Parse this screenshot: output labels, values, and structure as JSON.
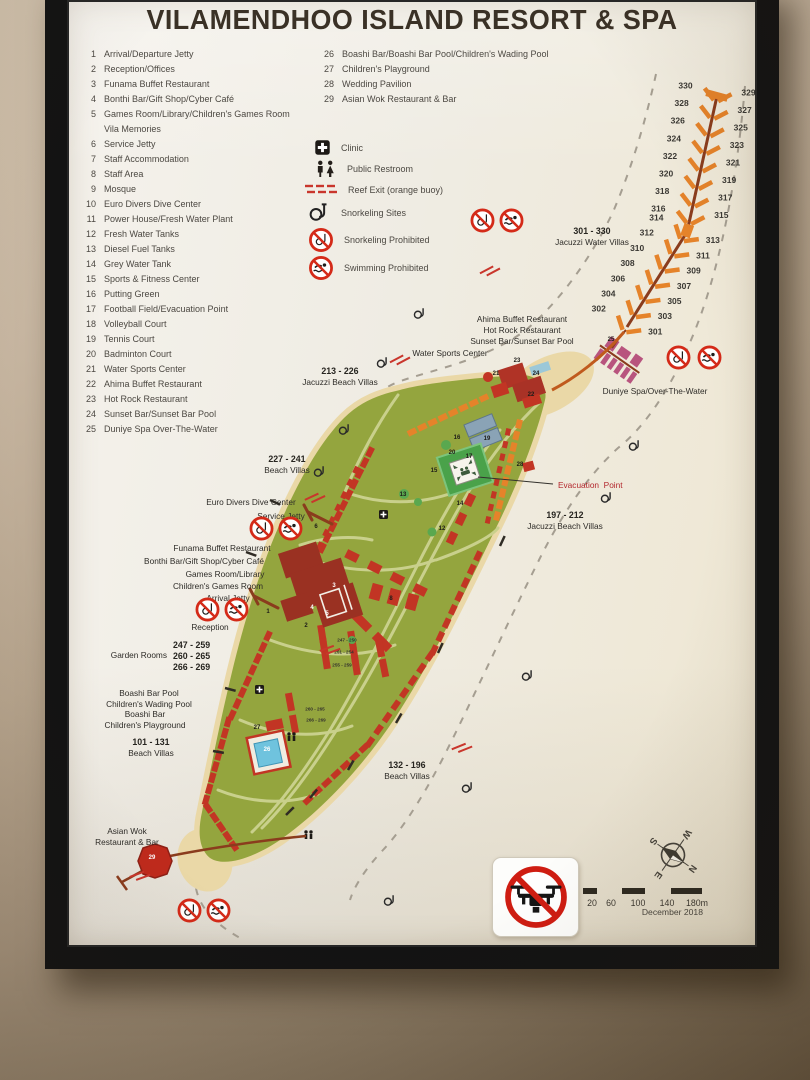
{
  "poster": {
    "title": "VILAMENDHOO ISLAND RESORT & SPA"
  },
  "colors": {
    "island_green": "#94a53e",
    "path_green": "#c9d08c",
    "sand": "#ead8a7",
    "villa_red": "#c23524",
    "villa_orange": "#e5832a",
    "complex_red": "#9a3122",
    "spa_pink": "#b8547e",
    "prohibition_red": "#d42a18",
    "reef_gray": "#a59e91",
    "reef_exit_red": "#c9362c",
    "jetty_brown": "#8a3c1d",
    "evacuation_red": "#b3272d",
    "tennis_blue": "#8aa3b6",
    "pool_blue": "#6fc3de",
    "field_green": "#4aa24a"
  },
  "legend": {
    "items_left": [
      {
        "num": "1",
        "label": "Arrival/Departure Jetty"
      },
      {
        "num": "2",
        "label": "Reception/Offices"
      },
      {
        "num": "3",
        "label": "Funama Buffet Restaurant"
      },
      {
        "num": "4",
        "label": "Bonthi Bar/Gift Shop/Cyber Café"
      },
      {
        "num": "5",
        "label": "Games Room/Library/Children's Games Room"
      },
      {
        "num": "",
        "label": "Vila Memories"
      },
      {
        "num": "6",
        "label": "Service Jetty"
      },
      {
        "num": "7",
        "label": "Staff Accommodation"
      },
      {
        "num": "8",
        "label": "Staff Area"
      },
      {
        "num": "9",
        "label": "Mosque"
      },
      {
        "num": "10",
        "label": "Euro Divers Dive Center"
      },
      {
        "num": "11",
        "label": "Power House/Fresh Water Plant"
      },
      {
        "num": "12",
        "label": "Fresh Water Tanks"
      },
      {
        "num": "13",
        "label": "Diesel Fuel Tanks"
      },
      {
        "num": "14",
        "label": "Grey Water Tank"
      },
      {
        "num": "15",
        "label": "Sports & Fitness Center"
      },
      {
        "num": "16",
        "label": "Putting Green"
      },
      {
        "num": "17",
        "label": "Football Field/Evacuation Point"
      },
      {
        "num": "18",
        "label": "Volleyball Court"
      },
      {
        "num": "19",
        "label": "Tennis Court"
      },
      {
        "num": "20",
        "label": "Badminton Court"
      },
      {
        "num": "21",
        "label": "Water Sports Center"
      },
      {
        "num": "22",
        "label": "Ahima Buffet Restaurant"
      },
      {
        "num": "23",
        "label": "Hot Rock Restaurant"
      },
      {
        "num": "24",
        "label": "Sunset Bar/Sunset Bar Pool"
      },
      {
        "num": "25",
        "label": "Duniye Spa Over-The-Water"
      }
    ],
    "items_right": [
      {
        "num": "26",
        "label": "Boashi Bar/Boashi Bar Pool/Children's Wading Pool"
      },
      {
        "num": "27",
        "label": "Children's Playground"
      },
      {
        "num": "28",
        "label": "Wedding Pavilion"
      },
      {
        "num": "29",
        "label": "Asian Wok Restaurant & Bar"
      }
    ],
    "symbols": [
      {
        "icon": "clinic-icon",
        "label": "Clinic"
      },
      {
        "icon": "restroom-icon",
        "label": "Public Restroom"
      },
      {
        "icon": "reef-exit-icon",
        "label": "Reef Exit (orange buoy)"
      },
      {
        "icon": "snorkel-icon",
        "label": "Snorkeling Sites"
      },
      {
        "icon": "no-snorkel-icon",
        "label": "Snorkeling Prohibited"
      },
      {
        "icon": "no-swim-icon",
        "label": "Swimming Prohibited"
      }
    ]
  },
  "map": {
    "labels": [
      {
        "x": 340,
        "y": 366,
        "align": "center",
        "lines": [
          {
            "t": "213 - 226",
            "b": 1
          },
          {
            "t": "Jacuzzi Beach Villas",
            "b": 0
          }
        ]
      },
      {
        "x": 287,
        "y": 454,
        "align": "center",
        "lines": [
          {
            "t": "227 - 241",
            "b": 1
          },
          {
            "t": "Beach Villas",
            "b": 0
          }
        ]
      },
      {
        "x": 251,
        "y": 497,
        "align": "center",
        "lines": [
          {
            "t": "Euro Divers Dive Center",
            "b": 0
          }
        ]
      },
      {
        "x": 281,
        "y": 511,
        "align": "center",
        "lines": [
          {
            "t": "Service Jetty",
            "b": 0
          }
        ]
      },
      {
        "x": 222,
        "y": 543,
        "align": "center",
        "lines": [
          {
            "t": "Funama Buffet Restaurant",
            "b": 0
          }
        ]
      },
      {
        "x": 204,
        "y": 556,
        "align": "center",
        "lines": [
          {
            "t": "Bonthi Bar/Gift Shop/Cyber Café",
            "b": 0
          }
        ]
      },
      {
        "x": 225,
        "y": 569,
        "align": "center",
        "lines": [
          {
            "t": "Games Room/Library",
            "b": 0
          }
        ]
      },
      {
        "x": 218,
        "y": 581,
        "align": "center",
        "lines": [
          {
            "t": "Children's Games Room",
            "b": 0
          }
        ]
      },
      {
        "x": 228,
        "y": 593,
        "align": "center",
        "lines": [
          {
            "t": "Arrival Jetty",
            "b": 0
          }
        ]
      },
      {
        "x": 210,
        "y": 622,
        "align": "center",
        "lines": [
          {
            "t": "Reception",
            "b": 0
          }
        ]
      },
      {
        "x": 167,
        "y": 650,
        "align": "right",
        "lines": [
          {
            "t": "Garden Rooms",
            "b": 0
          }
        ]
      },
      {
        "x": 173,
        "y": 640,
        "align": "left",
        "lines": [
          {
            "t": "247 - 259",
            "b": 1
          },
          {
            "t": "260 - 265",
            "b": 1
          },
          {
            "t": "266 - 269",
            "b": 1
          }
        ]
      },
      {
        "x": 149,
        "y": 688,
        "align": "center",
        "lines": [
          {
            "t": "Boashi Bar Pool",
            "b": 0
          },
          {
            "t": "Children's Wading Pool",
            "b": 0
          }
        ]
      },
      {
        "x": 145,
        "y": 709,
        "align": "center",
        "lines": [
          {
            "t": "Boashi Bar",
            "b": 0
          },
          {
            "t": "Children's Playground",
            "b": 0
          }
        ]
      },
      {
        "x": 151,
        "y": 737,
        "align": "center",
        "lines": [
          {
            "t": "101 - 131",
            "b": 1
          },
          {
            "t": "Beach Villas",
            "b": 0
          }
        ]
      },
      {
        "x": 127,
        "y": 826,
        "align": "center",
        "lines": [
          {
            "t": "Asian Wok",
            "b": 0
          },
          {
            "t": "Restaurant & Bar",
            "b": 0
          }
        ]
      },
      {
        "x": 522,
        "y": 314,
        "align": "center",
        "lines": [
          {
            "t": "Ahima Buffet Restaurant",
            "b": 0
          },
          {
            "t": "Hot Rock Restaurant",
            "b": 0
          },
          {
            "t": "Sunset Bar/Sunset Bar Pool",
            "b": 0
          }
        ]
      },
      {
        "x": 450,
        "y": 348,
        "align": "center",
        "lines": [
          {
            "t": "Water Sports Center",
            "b": 0
          }
        ]
      },
      {
        "x": 592,
        "y": 226,
        "align": "center",
        "lines": [
          {
            "t": "301 - 330",
            "b": 1
          },
          {
            "t": "Jacuzzi Water Villas",
            "b": 0
          }
        ]
      },
      {
        "x": 655,
        "y": 386,
        "align": "center",
        "lines": [
          {
            "t": "Duniye Spa/Over-The-Water",
            "b": 0
          }
        ]
      },
      {
        "x": 558,
        "y": 480,
        "align": "left",
        "color": "#b3272d",
        "lines": [
          {
            "t": "Evacuation  Point",
            "b": 0
          }
        ]
      },
      {
        "x": 565,
        "y": 510,
        "align": "center",
        "lines": [
          {
            "t": "197 - 212",
            "b": 1
          },
          {
            "t": "Jacuzzi Beach Villas",
            "b": 0
          }
        ]
      },
      {
        "x": 407,
        "y": 760,
        "align": "center",
        "lines": [
          {
            "t": "132 - 196",
            "b": 1
          },
          {
            "t": "Beach Villas",
            "b": 0
          }
        ]
      }
    ],
    "markers_dark": [
      {
        "n": "1",
        "x": 268,
        "y": 612
      },
      {
        "n": "2",
        "x": 306,
        "y": 626
      },
      {
        "n": "6",
        "x": 316,
        "y": 527
      },
      {
        "n": "8",
        "x": 391,
        "y": 599
      },
      {
        "n": "12",
        "x": 442,
        "y": 529
      },
      {
        "n": "13",
        "x": 403,
        "y": 495
      },
      {
        "n": "14",
        "x": 460,
        "y": 504
      },
      {
        "n": "15",
        "x": 434,
        "y": 471
      },
      {
        "n": "16",
        "x": 457,
        "y": 438
      },
      {
        "n": "17",
        "x": 469,
        "y": 457
      },
      {
        "n": "19",
        "x": 487,
        "y": 439
      },
      {
        "n": "20",
        "x": 452,
        "y": 453
      },
      {
        "n": "21",
        "x": 496,
        "y": 374
      },
      {
        "n": "22",
        "x": 531,
        "y": 395
      },
      {
        "n": "23",
        "x": 517,
        "y": 361
      },
      {
        "n": "24",
        "x": 536,
        "y": 374
      },
      {
        "n": "25",
        "x": 611,
        "y": 340
      },
      {
        "n": "27",
        "x": 257,
        "y": 728
      },
      {
        "n": "28",
        "x": 520,
        "y": 465
      }
    ],
    "markers_light": [
      {
        "n": "3",
        "x": 334,
        "y": 586
      },
      {
        "n": "4",
        "x": 312,
        "y": 608
      },
      {
        "n": "5",
        "x": 327,
        "y": 614
      },
      {
        "n": "26",
        "x": 267,
        "y": 750
      },
      {
        "n": "29",
        "x": 152,
        "y": 858
      }
    ],
    "garden_blocks": [
      {
        "t": "247 - 250",
        "x": 347,
        "y": 640
      },
      {
        "t": "251 - 254",
        "x": 344,
        "y": 652
      },
      {
        "t": "255 - 259",
        "x": 342,
        "y": 665
      },
      {
        "t": "260 - 265",
        "x": 315,
        "y": 709
      },
      {
        "t": "266 - 269",
        "x": 316,
        "y": 720
      }
    ],
    "prohibition_signs": [
      {
        "x": 483,
        "y": 221,
        "type": "no-snorkel-icon"
      },
      {
        "x": 512,
        "y": 221,
        "type": "no-swim-icon"
      },
      {
        "x": 679,
        "y": 358,
        "type": "no-snorkel-icon"
      },
      {
        "x": 710,
        "y": 358,
        "type": "no-swim-icon"
      },
      {
        "x": 262,
        "y": 529,
        "type": "no-snorkel-icon"
      },
      {
        "x": 291,
        "y": 529,
        "type": "no-swim-icon"
      },
      {
        "x": 208,
        "y": 610,
        "type": "no-snorkel-icon"
      },
      {
        "x": 237,
        "y": 610,
        "type": "no-swim-icon"
      },
      {
        "x": 190,
        "y": 911,
        "type": "no-snorkel-icon"
      },
      {
        "x": 219,
        "y": 911,
        "type": "no-swim-icon"
      }
    ],
    "snorkel_sites": [
      {
        "x": 420,
        "y": 314
      },
      {
        "x": 383,
        "y": 363
      },
      {
        "x": 345,
        "y": 430
      },
      {
        "x": 320,
        "y": 472
      },
      {
        "x": 635,
        "y": 446
      },
      {
        "x": 607,
        "y": 498
      },
      {
        "x": 528,
        "y": 676
      },
      {
        "x": 468,
        "y": 788
      },
      {
        "x": 390,
        "y": 901
      }
    ],
    "reef_exits": [
      {
        "x": 490,
        "y": 271,
        "r": -28
      },
      {
        "x": 400,
        "y": 360,
        "r": -28
      },
      {
        "x": 315,
        "y": 498,
        "r": -25
      },
      {
        "x": 330,
        "y": 650,
        "r": -20
      },
      {
        "x": 462,
        "y": 748,
        "r": -22
      },
      {
        "x": 140,
        "y": 876,
        "r": -20
      }
    ],
    "water_villas": {
      "left_numbers": [
        302,
        304,
        306,
        308,
        310,
        312,
        314,
        316,
        318,
        320,
        322,
        324,
        326,
        328,
        330
      ],
      "right_numbers": [
        301,
        303,
        305,
        307,
        309,
        311,
        313,
        315,
        317,
        319,
        321,
        323,
        325,
        327,
        329
      ]
    }
  },
  "footer": {
    "scale_labels": [
      {
        "t": "20",
        "x": 9
      },
      {
        "t": "60",
        "x": 28
      },
      {
        "t": "100",
        "x": 55
      },
      {
        "t": "140",
        "x": 84
      },
      {
        "t": "180m",
        "x": 114
      }
    ],
    "date": "December 2018",
    "compass": {
      "n": "N",
      "e": "E",
      "s": "S",
      "w": "W"
    }
  }
}
